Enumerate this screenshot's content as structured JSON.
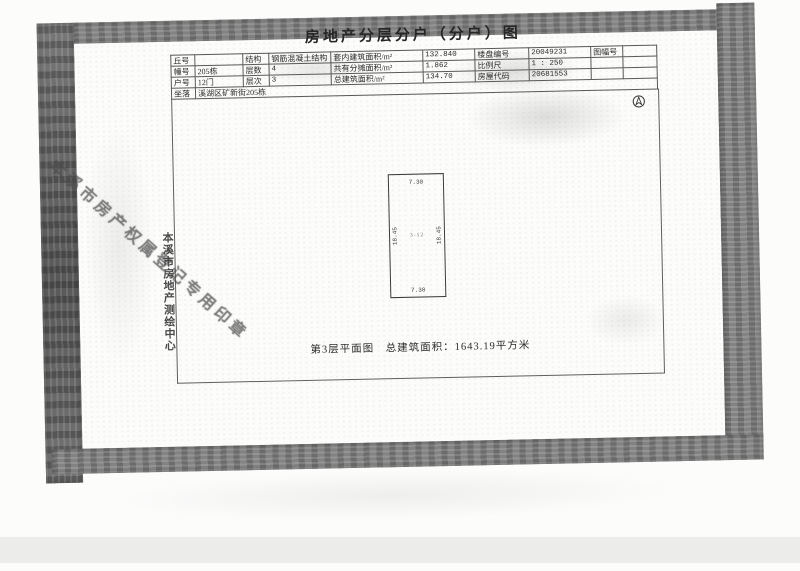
{
  "doc": {
    "title": "房地产分层分户（分户）图",
    "table": {
      "r1": [
        "丘号",
        "",
        "结构",
        "钢筋混凝土结构",
        "套内建筑面积/m²",
        "132.840",
        "楼盘编号",
        "20049231",
        "图幅号",
        ""
      ],
      "r2": [
        "幢号",
        "205栋",
        "层数",
        "4",
        "共有分摊面积/m²",
        "1.862",
        "比例尺",
        "1 : 250",
        "",
        ""
      ],
      "r3": [
        "户号",
        "12门",
        "层次",
        "3",
        "总建筑面积/m²",
        "134.70",
        "房屋代码",
        "20681553",
        "",
        ""
      ],
      "r4": [
        "坐落",
        "溪湖区矿新街205栋"
      ]
    },
    "plan": {
      "top_dim": "7.30",
      "bottom_dim": "7.30",
      "left_dim": "18.45",
      "right_dim": "18.45",
      "unit_no": "3-12",
      "caption": "第3层平面图　总建筑面积：1643.19平方米"
    },
    "stamps": {
      "center_name_vertical": "本溪市房地产测绘中心",
      "seal_diagonal": "本溪市房产权属登记专用印章"
    },
    "icons": {
      "north_arrow": "compass-north-icon"
    },
    "colors": {
      "photocopy_edge_gray": "#838383",
      "table_line": "#585858",
      "ink": "#2f2f2f"
    }
  }
}
